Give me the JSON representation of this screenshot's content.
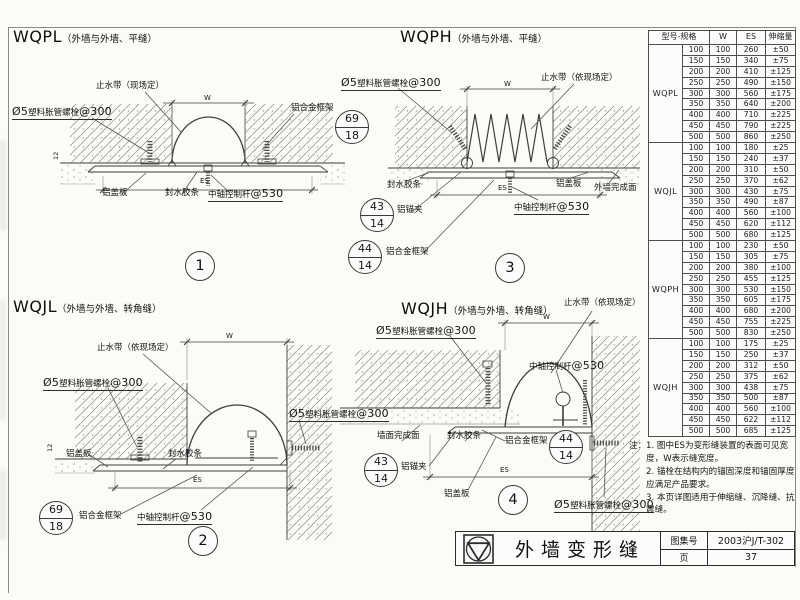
{
  "shared": {
    "bolt": {
      "pre": "Ø5",
      "mid": "塑料胀管螺栓",
      "suf": "@300"
    },
    "rod": {
      "pre": "中轴控制杆",
      "suf": "@530"
    },
    "dim_w": "W",
    "dim_es": "ES",
    "dim_12": "12",
    "frame": "铝合金框架",
    "cover": "铝盖板",
    "seal": "封水胶条",
    "clamp": "铝锚夹",
    "waterstop_site": "止水带（现场定）",
    "waterstop_depends": "止水带（依现场定）",
    "wall_finish": "外墙完成面",
    "wall_face_finish": "墙面完成面",
    "ref_69_18": {
      "top": "69",
      "bot": "18"
    },
    "ref_43_14": {
      "top": "43",
      "bot": "14"
    },
    "ref_44_14": {
      "top": "44",
      "bot": "14"
    }
  },
  "drawings": {
    "d1": {
      "code": "WQPL",
      "subtitle": "（外墙与外墙、平缝）",
      "number": "1"
    },
    "d2": {
      "code": "WQJL",
      "subtitle": "（外墙与外墙、转角缝）",
      "number": "2"
    },
    "d3": {
      "code": "WQPH",
      "subtitle": "（外墙与外墙、平缝）",
      "number": "3"
    },
    "d4": {
      "code": "WQJH",
      "subtitle": "（外墙与外墙、转角缝）",
      "number": "4"
    }
  },
  "table": {
    "headers": {
      "model_spec": "型号-规格",
      "w": "W",
      "es": "ES",
      "expansion": "伸缩量"
    },
    "groups": [
      {
        "model": "WQPL",
        "rows": [
          [
            "100",
            "100",
            "260",
            "±50"
          ],
          [
            "150",
            "150",
            "340",
            "±75"
          ],
          [
            "200",
            "200",
            "410",
            "±125"
          ],
          [
            "250",
            "250",
            "490",
            "±150"
          ],
          [
            "300",
            "300",
            "560",
            "±175"
          ],
          [
            "350",
            "350",
            "640",
            "±200"
          ],
          [
            "400",
            "400",
            "710",
            "±225"
          ],
          [
            "450",
            "450",
            "790",
            "±225"
          ],
          [
            "500",
            "500",
            "860",
            "±250"
          ]
        ]
      },
      {
        "model": "WQJL",
        "rows": [
          [
            "100",
            "100",
            "180",
            "±25"
          ],
          [
            "150",
            "150",
            "240",
            "±37"
          ],
          [
            "200",
            "200",
            "310",
            "±50"
          ],
          [
            "250",
            "250",
            "370",
            "±62"
          ],
          [
            "300",
            "300",
            "430",
            "±75"
          ],
          [
            "350",
            "350",
            "490",
            "±87"
          ],
          [
            "400",
            "400",
            "560",
            "±100"
          ],
          [
            "450",
            "450",
            "620",
            "±112"
          ],
          [
            "500",
            "500",
            "680",
            "±125"
          ]
        ]
      },
      {
        "model": "WQPH",
        "rows": [
          [
            "100",
            "100",
            "230",
            "±50"
          ],
          [
            "150",
            "150",
            "305",
            "±75"
          ],
          [
            "200",
            "200",
            "380",
            "±100"
          ],
          [
            "250",
            "250",
            "455",
            "±125"
          ],
          [
            "300",
            "300",
            "530",
            "±150"
          ],
          [
            "350",
            "350",
            "605",
            "±175"
          ],
          [
            "400",
            "400",
            "680",
            "±200"
          ],
          [
            "450",
            "450",
            "755",
            "±225"
          ],
          [
            "500",
            "500",
            "830",
            "±250"
          ]
        ]
      },
      {
        "model": "WQJH",
        "rows": [
          [
            "100",
            "100",
            "175",
            "±25"
          ],
          [
            "150",
            "150",
            "250",
            "±37"
          ],
          [
            "200",
            "200",
            "312",
            "±50"
          ],
          [
            "250",
            "250",
            "375",
            "±62"
          ],
          [
            "300",
            "300",
            "438",
            "±75"
          ],
          [
            "350",
            "350",
            "500",
            "±87"
          ],
          [
            "400",
            "400",
            "560",
            "±100"
          ],
          [
            "450",
            "450",
            "622",
            "±112"
          ],
          [
            "500",
            "500",
            "685",
            "±125"
          ]
        ]
      }
    ]
  },
  "notes": {
    "prefix": "注：",
    "n1": "1. 图中ES为变形缝装置的表面可见宽度，W表示缝宽度。",
    "n2": "2. 锚栓在结构内的锚固深度和锚固厚度应满足产品要求。",
    "n3": "3. 本页详图适用于伸缩缝、沉降缝、抗震缝。"
  },
  "titlebar": {
    "title": "外墙变形缝",
    "atlas_label": "图集号",
    "atlas_no": "2003沪J/T-302",
    "page_label": "页",
    "page_no": "37"
  }
}
